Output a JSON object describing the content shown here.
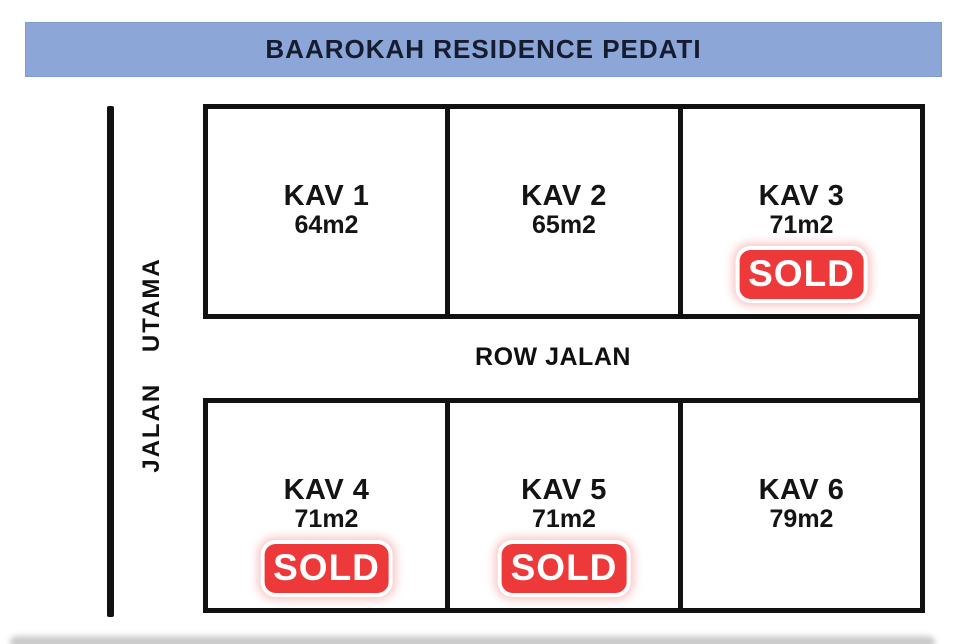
{
  "title": "BAAROKAH RESIDENCE PEDATI",
  "roads": {
    "main_road_label": "JALAN UTAMA",
    "row_road_label": "ROW JALAN"
  },
  "sold_label": "SOLD",
  "plots": [
    {
      "name": "KAV 1",
      "area": "64m2",
      "sold": false
    },
    {
      "name": "KAV 2",
      "area": "65m2",
      "sold": false
    },
    {
      "name": "KAV 3",
      "area": "71m2",
      "sold": true
    },
    {
      "name": "KAV 4",
      "area": "71m2",
      "sold": true
    },
    {
      "name": "KAV 5",
      "area": "71m2",
      "sold": true
    },
    {
      "name": "KAV 6",
      "area": "79m2",
      "sold": false
    }
  ],
  "colors": {
    "banner_bg": "#8ca6d8",
    "banner_edge": "#7e9ccf",
    "banner_text": "#161c30",
    "line": "#111111",
    "sold_bg": "#ee393b",
    "sold_text": "#ffffff"
  }
}
